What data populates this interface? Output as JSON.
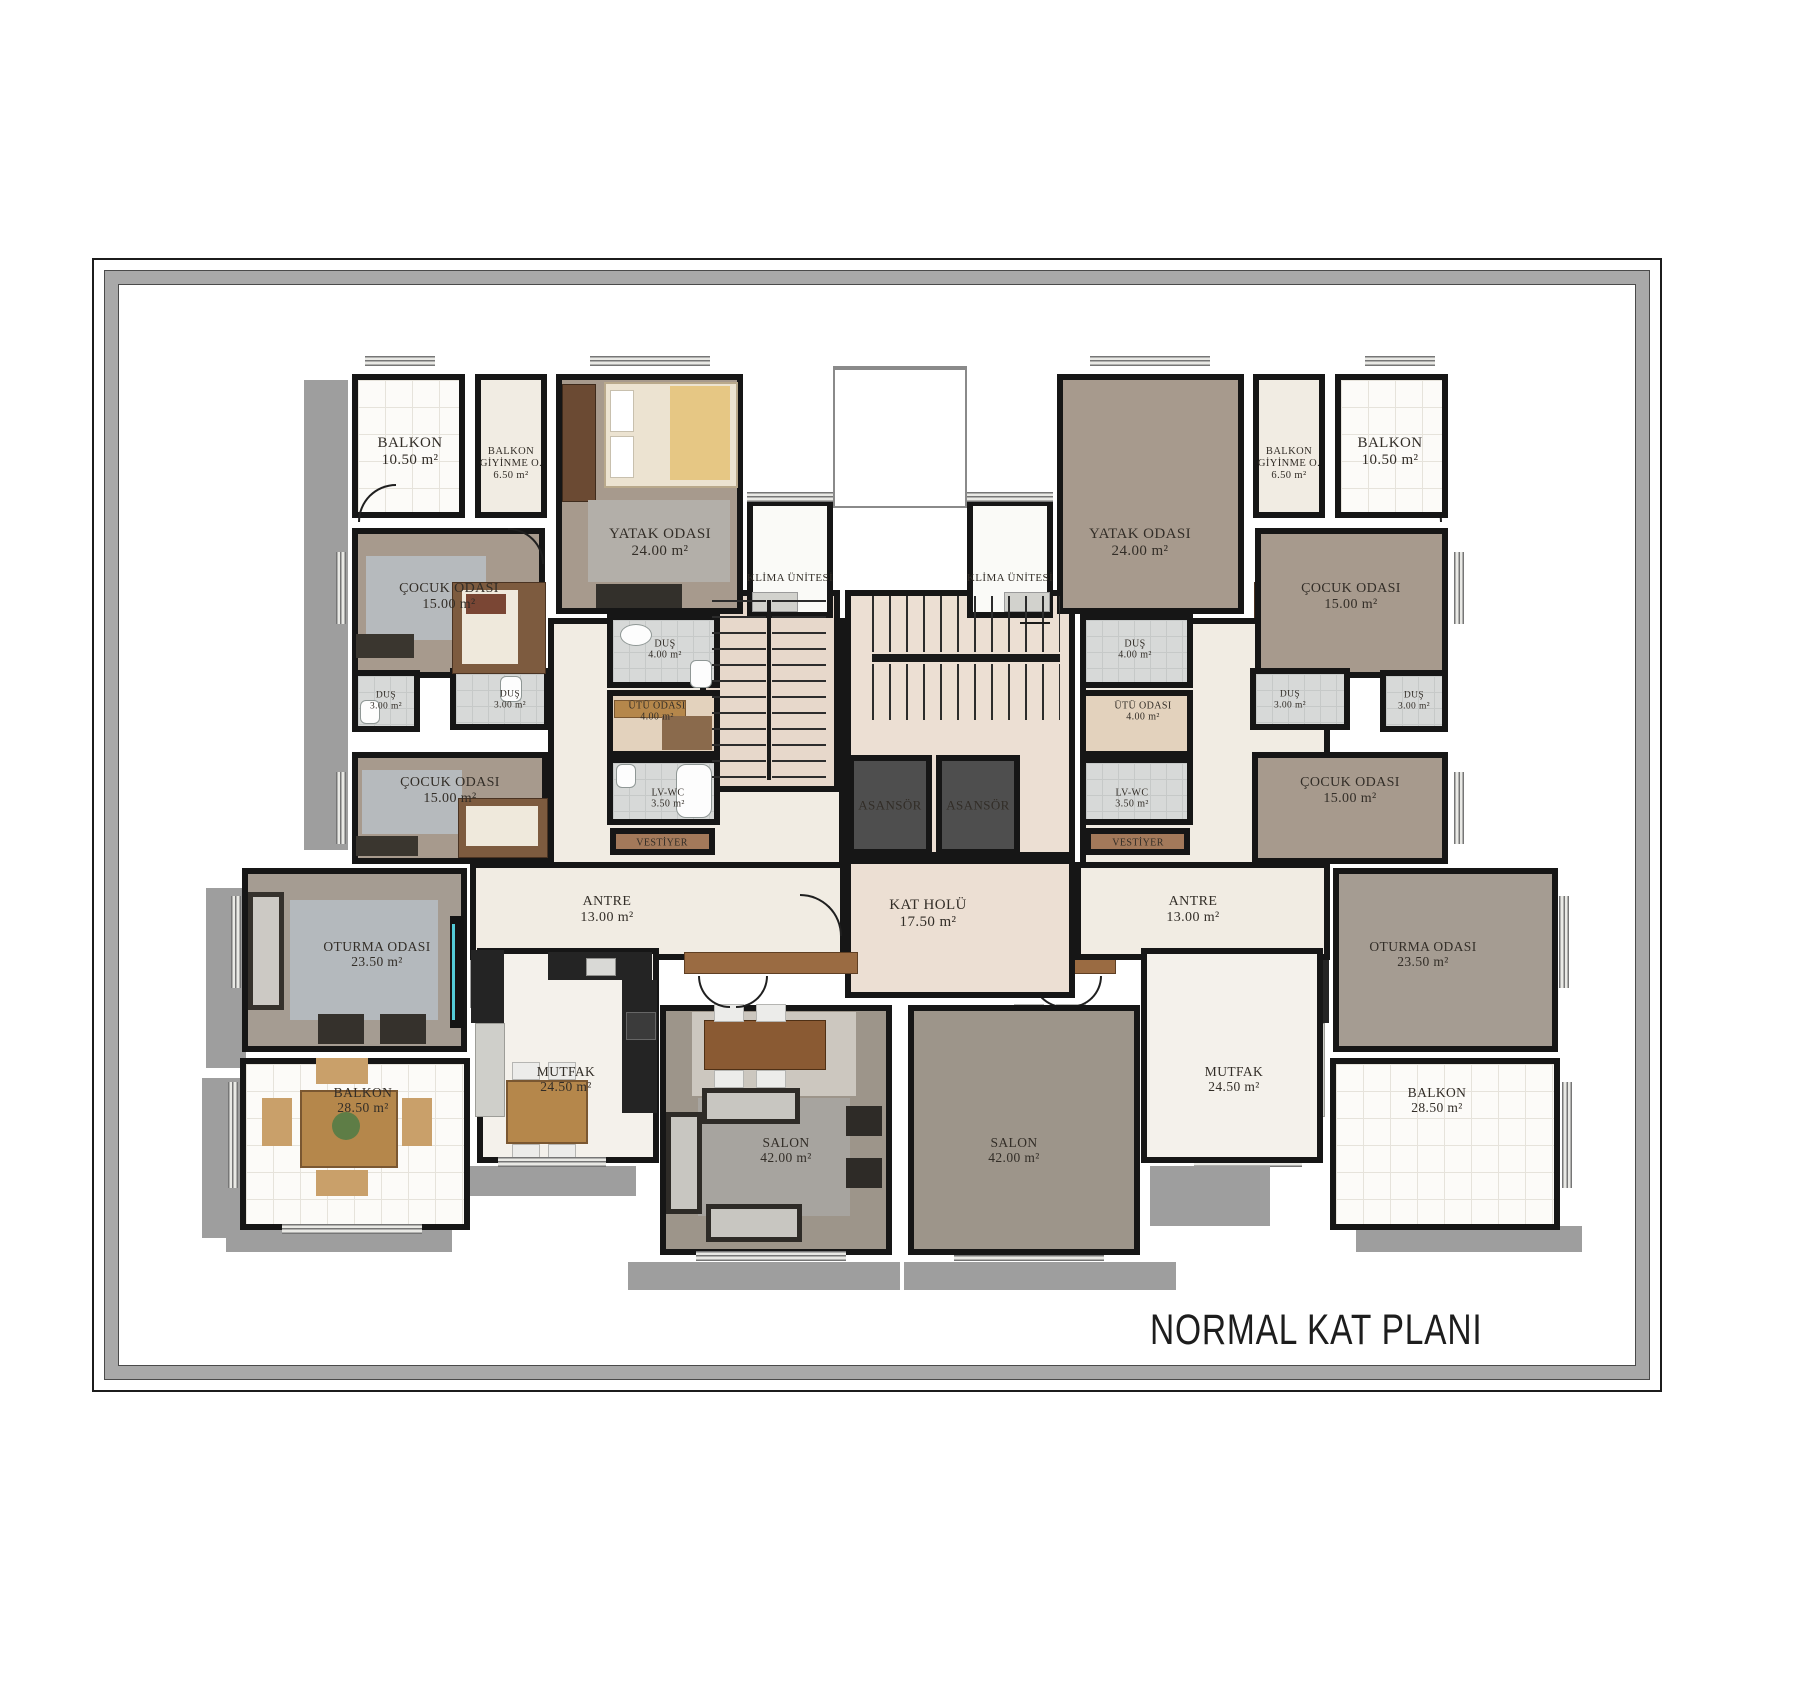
{
  "title": "NORMAL KAT PLANI",
  "colors": {
    "wall": "#161616",
    "shadow": "#9e9e9e",
    "mat": "#a9a9a9",
    "taupe": "#a79a8d",
    "taupe2": "#a59c92",
    "salonbg": "#9d958a",
    "cream": "#f1ece3",
    "tile": "#fcfbf8",
    "bath": "#d7d9d8",
    "kitchen": "#f4f1eb",
    "hall": "#ecdfd3",
    "stair": "#e7d8cb",
    "elev": "#4e4e4e",
    "wood": "#a3795a",
    "klima": "#fafaf7",
    "utufloor": "#e3d2bd",
    "white": "#ffffff",
    "accent_cyan": "#54cbd8"
  },
  "rooms": [
    {
      "id": "corridor-left",
      "box": [
        548,
        618,
        297,
        250
      ],
      "bg": "cream",
      "cls": "under"
    },
    {
      "id": "corridor-right",
      "box": [
        1080,
        618,
        250,
        250
      ],
      "bg": "cream",
      "cls": "under"
    },
    {
      "id": "stair-core",
      "box": [
        845,
        590,
        230,
        268
      ],
      "bg": "hall",
      "cls": "under"
    },
    {
      "id": "stair-left",
      "box": [
        700,
        590,
        140,
        202
      ],
      "bg": "stair"
    },
    {
      "id": "light-shaft",
      "box": [
        833,
        368,
        134,
        140
      ],
      "bg": "white",
      "cls": "thin"
    },
    {
      "id": "kat-holu",
      "box": [
        845,
        858,
        230,
        140
      ],
      "bg": "hall",
      "lines": [
        "KAT HOLÜ",
        "17.50 m²"
      ],
      "lx": 928,
      "ly": 914,
      "fs": 15
    },
    {
      "id": "klima-unit-left",
      "box": [
        747,
        500,
        86,
        118
      ],
      "bg": "klima",
      "lines": [
        "KLİMA ÜNİTESİ"
      ],
      "lx": 790,
      "ly": 578,
      "fs": 11
    },
    {
      "id": "klima-unit-right",
      "box": [
        967,
        500,
        86,
        118
      ],
      "bg": "klima",
      "lines": [
        "KLİMA ÜNİTESİ"
      ],
      "lx": 1010,
      "ly": 578,
      "fs": 11
    },
    {
      "id": "balkon-top-left",
      "box": [
        352,
        374,
        113,
        144
      ],
      "bg": "tile",
      "cls": "tile",
      "lines": [
        "BALKON",
        "10.50 m²"
      ],
      "lx": 410,
      "ly": 452,
      "fs": 15
    },
    {
      "id": "giyinme-left",
      "box": [
        475,
        374,
        72,
        144
      ],
      "bg": "cream",
      "lines": [
        "BALKON",
        "GİYİNME O.",
        "6.50 m²"
      ],
      "lx": 511,
      "ly": 464,
      "fs": 10.5
    },
    {
      "id": "yatak-odasi-left",
      "box": [
        556,
        374,
        187,
        240
      ],
      "bg": "taupe",
      "lines": [
        "YATAK ODASI",
        "24.00 m²"
      ],
      "lx": 660,
      "ly": 543,
      "fs": 15
    },
    {
      "id": "cocuk-odasi-1-left",
      "box": [
        352,
        528,
        193,
        150
      ],
      "bg": "taupe",
      "lines": [
        "ÇOCUK ODASI",
        "15.00 m²"
      ],
      "lx": 449,
      "ly": 597,
      "fs": 14
    },
    {
      "id": "dus4-left",
      "box": [
        607,
        614,
        113,
        74
      ],
      "bg": "bath",
      "cls": "bgrid",
      "lines": [
        "DUŞ",
        "4.00 m²"
      ],
      "lx": 665,
      "ly": 650,
      "fs": 10
    },
    {
      "id": "dus3a-left",
      "box": [
        352,
        670,
        68,
        62
      ],
      "bg": "bath",
      "cls": "bgrid",
      "lines": [
        "DUŞ",
        "3.00 m²"
      ],
      "lx": 386,
      "ly": 701,
      "fs": 9.5
    },
    {
      "id": "dus3b-left",
      "box": [
        450,
        668,
        100,
        62
      ],
      "bg": "bath",
      "cls": "bgrid",
      "lines": [
        "DUŞ",
        "3.00 m²"
      ],
      "lx": 510,
      "ly": 700,
      "fs": 9.5
    },
    {
      "id": "utu-odasi-left",
      "box": [
        607,
        690,
        113,
        67
      ],
      "bg": "utufloor",
      "lines": [
        "ÜTÜ ODASI",
        "4.00 m²"
      ],
      "lx": 657,
      "ly": 712,
      "fs": 10
    },
    {
      "id": "cocuk-odasi-2-left",
      "box": [
        352,
        752,
        196,
        112
      ],
      "bg": "taupe",
      "lines": [
        "ÇOCUK ODASI",
        "15.00 m²"
      ],
      "lx": 450,
      "ly": 791,
      "fs": 14
    },
    {
      "id": "lv-wc-left",
      "box": [
        607,
        757,
        113,
        68
      ],
      "bg": "bath",
      "cls": "bgrid",
      "lines": [
        "LV-WC",
        "3.50 m²"
      ],
      "lx": 668,
      "ly": 799,
      "fs": 10
    },
    {
      "id": "vestiyer-left",
      "box": [
        610,
        828,
        105,
        27
      ],
      "bg": "wood",
      "lines": [
        "VESTİYER"
      ],
      "lx": 662,
      "ly": 843,
      "fs": 10
    },
    {
      "id": "antre-left",
      "box": [
        470,
        862,
        376,
        98
      ],
      "bg": "cream",
      "lines": [
        "ANTRE",
        "13.00 m²"
      ],
      "lx": 607,
      "ly": 910,
      "fs": 14
    },
    {
      "id": "oturma-odasi-left",
      "box": [
        242,
        868,
        225,
        184
      ],
      "bg": "taupe2",
      "lines": [
        "OTURMA ODASI",
        "23.50 m²"
      ],
      "lx": 377,
      "ly": 954,
      "fs": 13.5
    },
    {
      "id": "balkon-bottom-left",
      "box": [
        240,
        1058,
        230,
        172
      ],
      "bg": "tile",
      "cls": "tile",
      "lines": [
        "BALKON",
        "28.50 m²"
      ],
      "lx": 363,
      "ly": 1100,
      "fs": 13.5
    },
    {
      "id": "mutfak-left",
      "box": [
        477,
        948,
        182,
        215
      ],
      "bg": "kitchen",
      "lines": [
        "MUTFAK",
        "24.50 m²"
      ],
      "lx": 566,
      "ly": 1079,
      "fs": 13.5
    },
    {
      "id": "salon-left",
      "box": [
        660,
        1005,
        232,
        250
      ],
      "bg": "salonbg",
      "lines": [
        "SALON",
        "42.00 m²"
      ],
      "lx": 786,
      "ly": 1150,
      "fs": 13.5
    },
    {
      "id": "balkon-top-right",
      "box": [
        1335,
        374,
        113,
        144
      ],
      "bg": "tile",
      "cls": "tile",
      "lines": [
        "BALKON",
        "10.50 m²"
      ],
      "lx": 1390,
      "ly": 452,
      "fs": 15
    },
    {
      "id": "giyinme-right",
      "box": [
        1253,
        374,
        72,
        144
      ],
      "bg": "cream",
      "lines": [
        "BALKON",
        "GİYİNME O.",
        "6.50 m²"
      ],
      "lx": 1289,
      "ly": 464,
      "fs": 10.5
    },
    {
      "id": "yatak-odasi-right",
      "box": [
        1057,
        374,
        187,
        240
      ],
      "bg": "taupe",
      "lines": [
        "YATAK ODASI",
        "24.00 m²"
      ],
      "lx": 1140,
      "ly": 543,
      "fs": 15
    },
    {
      "id": "cocuk-odasi-1-right",
      "box": [
        1255,
        528,
        193,
        150
      ],
      "bg": "taupe",
      "lines": [
        "ÇOCUK ODASI",
        "15.00 m²"
      ],
      "lx": 1351,
      "ly": 597,
      "fs": 14
    },
    {
      "id": "dus4-right",
      "box": [
        1080,
        614,
        113,
        74
      ],
      "bg": "bath",
      "cls": "bgrid",
      "lines": [
        "DUŞ",
        "4.00 m²"
      ],
      "lx": 1135,
      "ly": 650,
      "fs": 10
    },
    {
      "id": "dus3a-right",
      "box": [
        1380,
        670,
        68,
        62
      ],
      "bg": "bath",
      "cls": "bgrid",
      "lines": [
        "DUŞ",
        "3.00 m²"
      ],
      "lx": 1414,
      "ly": 701,
      "fs": 9.5
    },
    {
      "id": "dus3b-right",
      "box": [
        1250,
        668,
        100,
        62
      ],
      "bg": "bath",
      "cls": "bgrid",
      "lines": [
        "DUŞ",
        "3.00 m²"
      ],
      "lx": 1290,
      "ly": 700,
      "fs": 9.5
    },
    {
      "id": "utu-odasi-right",
      "box": [
        1080,
        690,
        113,
        67
      ],
      "bg": "utufloor",
      "lines": [
        "ÜTÜ ODASI",
        "4.00 m²"
      ],
      "lx": 1143,
      "ly": 712,
      "fs": 10
    },
    {
      "id": "cocuk-odasi-2-right",
      "box": [
        1252,
        752,
        196,
        112
      ],
      "bg": "taupe",
      "lines": [
        "ÇOCUK ODASI",
        "15.00 m²"
      ],
      "lx": 1350,
      "ly": 791,
      "fs": 14
    },
    {
      "id": "lv-wc-right",
      "box": [
        1080,
        757,
        113,
        68
      ],
      "bg": "bath",
      "cls": "bgrid",
      "lines": [
        "LV-WC",
        "3.50 m²"
      ],
      "lx": 1132,
      "ly": 799,
      "fs": 10
    },
    {
      "id": "vestiyer-right",
      "box": [
        1085,
        828,
        105,
        27
      ],
      "bg": "wood",
      "lines": [
        "VESTİYER"
      ],
      "lx": 1138,
      "ly": 843,
      "fs": 10
    },
    {
      "id": "antre-right",
      "box": [
        1075,
        862,
        255,
        98
      ],
      "bg": "cream",
      "lines": [
        "ANTRE",
        "13.00 m²"
      ],
      "lx": 1193,
      "ly": 910,
      "fs": 14
    },
    {
      "id": "oturma-odasi-right",
      "box": [
        1333,
        868,
        225,
        184
      ],
      "bg": "taupe2",
      "lines": [
        "OTURMA ODASI",
        "23.50 m²"
      ],
      "lx": 1423,
      "ly": 954,
      "fs": 13.5
    },
    {
      "id": "balkon-bottom-right",
      "box": [
        1330,
        1058,
        230,
        172
      ],
      "bg": "tile",
      "cls": "tile",
      "lines": [
        "BALKON",
        "28.50 m²"
      ],
      "lx": 1437,
      "ly": 1100,
      "fs": 13.5
    },
    {
      "id": "mutfak-right",
      "box": [
        1141,
        948,
        182,
        215
      ],
      "bg": "kitchen",
      "lines": [
        "MUTFAK",
        "24.50 m²"
      ],
      "lx": 1234,
      "ly": 1079,
      "fs": 13.5
    },
    {
      "id": "salon-right",
      "box": [
        908,
        1005,
        232,
        250
      ],
      "bg": "salonbg",
      "lines": [
        "SALON",
        "42.00 m²"
      ],
      "lx": 1014,
      "ly": 1150,
      "fs": 13.5
    },
    {
      "id": "asansor-left",
      "box": [
        848,
        755,
        84,
        100
      ],
      "bg": "elev",
      "cls": "ontop",
      "lines": [
        "ASANSÖR"
      ],
      "lx": 890,
      "ly": 806,
      "fs": 13
    },
    {
      "id": "asansor-right",
      "box": [
        936,
        755,
        84,
        100
      ],
      "bg": "elev",
      "cls": "ontop",
      "lines": [
        "ASANSÖR"
      ],
      "lx": 978,
      "ly": 806,
      "fs": 13
    }
  ],
  "shadows": [
    [
      304,
      380,
      44,
      470
    ],
    [
      206,
      888,
      40,
      180
    ],
    [
      202,
      1078,
      42,
      160
    ],
    [
      226,
      1226,
      226,
      26
    ],
    [
      456,
      1166,
      180,
      30
    ],
    [
      628,
      1262,
      272,
      28
    ],
    [
      904,
      1262,
      272,
      28
    ],
    [
      1150,
      1166,
      120,
      60
    ],
    [
      1356,
      1226,
      226,
      26
    ],
    [
      470,
      958,
      30,
      50
    ]
  ]
}
